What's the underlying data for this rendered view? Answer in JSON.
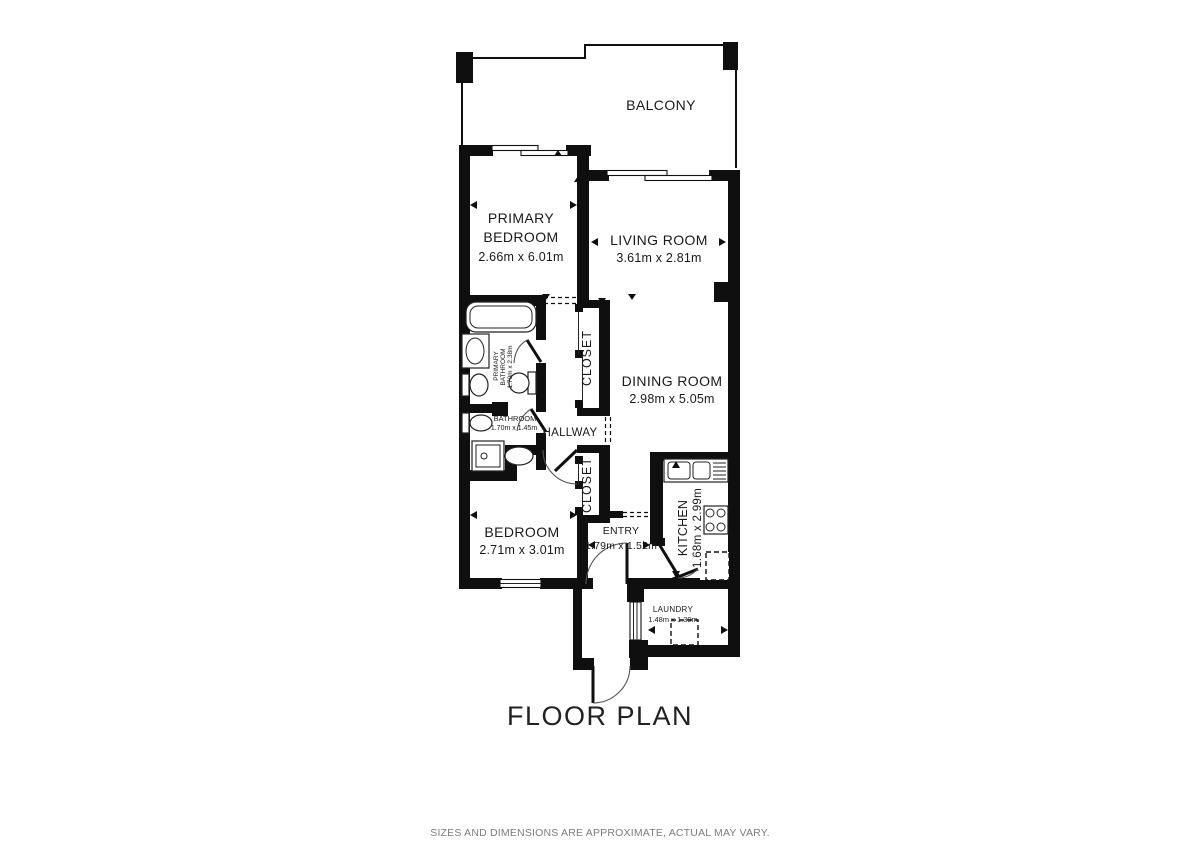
{
  "title": "FLOOR PLAN",
  "footer": {
    "disclaimer": "SIZES AND DIMENSIONS ARE APPROXIMATE, ACTUAL MAY VARY."
  },
  "colors": {
    "wall": "#0f0f0f",
    "text": "#1a1a1a",
    "disclaimer_text": "#7d7d7d",
    "background": "#ffffff"
  },
  "rooms": {
    "balcony": {
      "name": "BALCONY"
    },
    "primary_bedroom": {
      "name_line1": "PRIMARY",
      "name_line2": "BEDROOM",
      "dimensions": "2.66m x 6.01m"
    },
    "living_room": {
      "name": "LIVING ROOM",
      "dimensions": "3.61m x 2.81m"
    },
    "dining_room": {
      "name": "DINING ROOM",
      "dimensions": "2.98m x 5.05m"
    },
    "closet_upper": {
      "name": "CLOSET"
    },
    "closet_lower": {
      "name": "CLOSET"
    },
    "hallway": {
      "name": "HALLWAY"
    },
    "primary_bathroom": {
      "name_line1": "PRIMARY",
      "name_line2": "BATHROOM",
      "dimensions": "1.70m x 2.38m"
    },
    "bathroom": {
      "name": "BATHROOM",
      "dimensions": "1.70m x 1.45m"
    },
    "bedroom": {
      "name": "BEDROOM",
      "dimensions": "2.71m x 3.01m"
    },
    "entry": {
      "name": "ENTRY",
      "dimensions": "1.79m x 1.52m"
    },
    "kitchen": {
      "name": "KITCHEN",
      "dimensions": "1.68m x 2.99m"
    },
    "laundry": {
      "name": "LAUNDRY",
      "dimensions": "1.48m x 1.39m"
    }
  }
}
